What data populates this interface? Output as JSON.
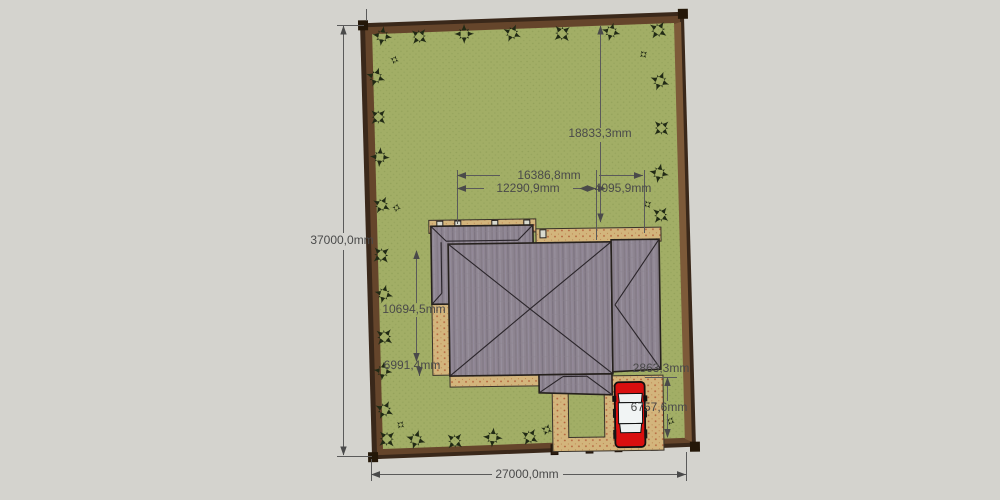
{
  "app": {
    "viewport_label": "3D site model top view"
  },
  "scene": {
    "units": "mm",
    "dimensions": {
      "plot_width_bottom": "27000,0mm",
      "plot_height_left": "37000,0mm",
      "setback_top": "18833,3mm",
      "house_total_width": "16386,8mm",
      "house_main_width": "12290,9mm",
      "house_right_width": "4095,9mm",
      "house_main_depth": "10694,5mm",
      "house_left_depth": "6991,4mm",
      "right_gap": "2863,3mm",
      "driveway_depth": "6757,6mm"
    },
    "objects": [
      "perimeter-fence",
      "lawn",
      "hip-roof-house",
      "paved-terrace",
      "driveway",
      "garden-bed",
      "red-car",
      "plan-trees"
    ],
    "colors": {
      "canvas": "#d4d3ce",
      "fence_dark": "#3a281a",
      "fence_mid": "#65452b",
      "fence_inner_face": "#7d5a39",
      "post": "#241708",
      "lawn": "#a2ae66",
      "lawn_dot": "#93a15a",
      "pave": "#d3b57c",
      "pave_dot": "#b2603a",
      "roof": "#8e8591",
      "outline": "#26211d",
      "tree": "#212a15",
      "dim": "#4f4f4f",
      "car_red": "#d90f0f",
      "car_white": "#eef1f1"
    },
    "trees": [
      {
        "x": 385,
        "y": 34,
        "s": 1,
        "r": 10,
        "type": "tree"
      },
      {
        "x": 422,
        "y": 35,
        "s": 0.95,
        "r": 40,
        "type": "tree"
      },
      {
        "x": 467,
        "y": 33,
        "s": 1,
        "r": 0,
        "type": "tree"
      },
      {
        "x": 515,
        "y": 33,
        "s": 0.95,
        "r": 25,
        "type": "tree"
      },
      {
        "x": 565,
        "y": 34,
        "s": 1,
        "r": 50,
        "type": "tree"
      },
      {
        "x": 614,
        "y": 33,
        "s": 0.95,
        "r": 15,
        "type": "tree"
      },
      {
        "x": 661,
        "y": 32,
        "s": 1,
        "r": 35,
        "type": "tree"
      },
      {
        "x": 397,
        "y": 58,
        "s": 0.45,
        "r": 20,
        "type": "bush"
      },
      {
        "x": 646,
        "y": 56,
        "s": 0.45,
        "r": 55,
        "type": "bush"
      },
      {
        "x": 378,
        "y": 75,
        "s": 1,
        "r": 20,
        "type": "tree"
      },
      {
        "x": 380,
        "y": 115,
        "s": 0.95,
        "r": 45,
        "type": "tree"
      },
      {
        "x": 381,
        "y": 155,
        "s": 1,
        "r": 5,
        "type": "tree"
      },
      {
        "x": 382,
        "y": 203,
        "s": 0.95,
        "r": 30,
        "type": "tree"
      },
      {
        "x": 397,
        "y": 206,
        "s": 0.45,
        "r": 10,
        "type": "bush"
      },
      {
        "x": 381,
        "y": 253,
        "s": 1,
        "r": 50,
        "type": "tree"
      },
      {
        "x": 383,
        "y": 292,
        "s": 0.95,
        "r": 15,
        "type": "tree"
      },
      {
        "x": 383,
        "y": 335,
        "s": 1,
        "r": 40,
        "type": "tree"
      },
      {
        "x": 381,
        "y": 369,
        "s": 0.95,
        "r": 8,
        "type": "tree"
      },
      {
        "x": 382,
        "y": 408,
        "s": 1,
        "r": 28,
        "type": "tree"
      },
      {
        "x": 398,
        "y": 423,
        "s": 0.45,
        "r": 35,
        "type": "bush"
      },
      {
        "x": 384,
        "y": 437,
        "s": 1,
        "r": 48,
        "type": "tree"
      },
      {
        "x": 662,
        "y": 83,
        "s": 1,
        "r": 22,
        "type": "tree"
      },
      {
        "x": 663,
        "y": 130,
        "s": 0.95,
        "r": 47,
        "type": "tree"
      },
      {
        "x": 660,
        "y": 175,
        "s": 1,
        "r": 12,
        "type": "tree"
      },
      {
        "x": 661,
        "y": 217,
        "s": 0.95,
        "r": 38,
        "type": "tree"
      },
      {
        "x": 648,
        "y": 206,
        "s": 0.45,
        "r": 60,
        "type": "bush"
      },
      {
        "x": 668,
        "y": 423,
        "s": 0.45,
        "r": 25,
        "type": "bush"
      },
      {
        "x": 413,
        "y": 438,
        "s": 1,
        "r": 18,
        "type": "tree"
      },
      {
        "x": 452,
        "y": 440,
        "s": 0.95,
        "r": 42,
        "type": "tree"
      },
      {
        "x": 490,
        "y": 437,
        "s": 1,
        "r": 6,
        "type": "tree"
      },
      {
        "x": 527,
        "y": 437,
        "s": 0.95,
        "r": 33,
        "type": "tree"
      },
      {
        "x": 544,
        "y": 430,
        "s": 0.6,
        "r": 20,
        "type": "tree"
      }
    ]
  }
}
